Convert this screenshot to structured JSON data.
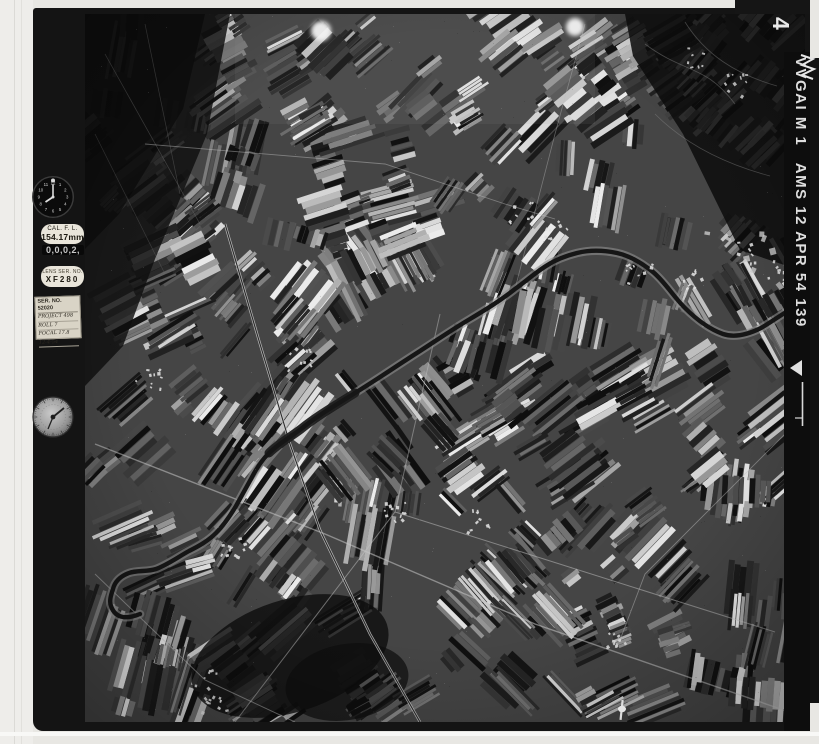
{
  "edge": {
    "frame_number": "4",
    "code": "VVGAI M 1   AMS 12 APR 54 139"
  },
  "instruments": {
    "clock": {
      "numbers": [
        "12",
        "1",
        "2",
        "3",
        "4",
        "5",
        "6",
        "7",
        "8",
        "9",
        "10",
        "11"
      ]
    },
    "cal_focal_length": {
      "label": "CAL. F. L.",
      "value": "154.17mm"
    },
    "frame_counter": {
      "value": "0,0,0,2,"
    },
    "lens_serial": {
      "label": "LENS SER. NO.",
      "value": "XF280"
    },
    "data_card": {
      "header": "SER. NO. 52020",
      "rows": [
        "PROJECT 498",
        "ROLL 7",
        "FOCAL 17.8",
        "12-4-54"
      ]
    }
  },
  "colors": {
    "margin": "#e8e7e3",
    "frame": "#141414",
    "photo_base": "#454545",
    "edge_text": "#dedede",
    "river": "#161616",
    "river_bank": "#8f8f8f",
    "road": "#c6c6c6",
    "village": "#e0e0e0"
  },
  "photo_features": {
    "subject": "black-and-white vertical aerial photograph",
    "terrain": "patchwork of narrow strip farm fields",
    "river": "dark meandering river crossing from upper right to lower left",
    "dark_areas": "wooded hills upper right, dark fields upper left, woodland lower center"
  }
}
